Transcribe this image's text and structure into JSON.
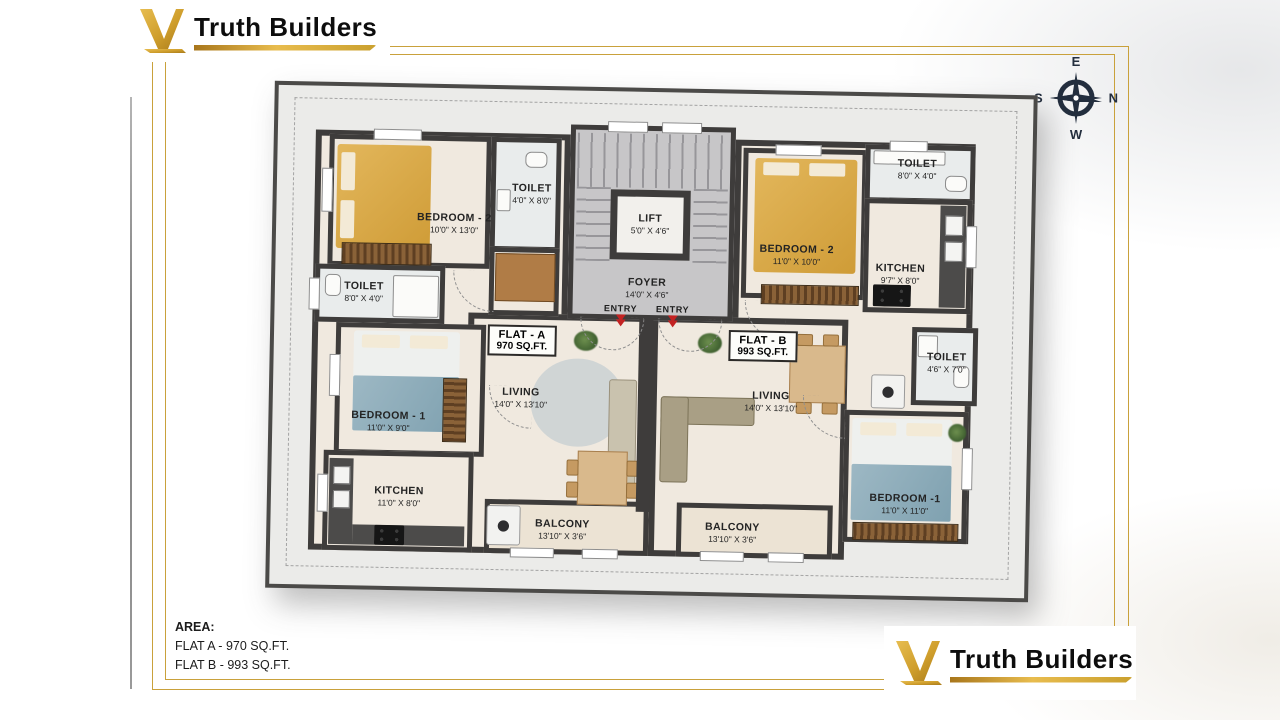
{
  "brand": {
    "name": "Truth Builders",
    "gold": "#D2A032",
    "text_color": "#0d0d0d"
  },
  "compass": {
    "top": "E",
    "right": "N",
    "left": "S",
    "bottom": "W"
  },
  "plan": {
    "flat_a": {
      "label": "FLAT - A",
      "area": "970 SQ.FT.",
      "bedroom2": {
        "name": "BEDROOM - 2",
        "dims": "10'0\" X 13'0\""
      },
      "toilet_attached": {
        "name": "TOILET",
        "dims": "4'0\" X 8'0\""
      },
      "toilet_common": {
        "name": "TOILET",
        "dims": "8'0\" X 4'0\""
      },
      "bedroom1": {
        "name": "BEDROOM - 1",
        "dims": "11'0\" X 9'0\""
      },
      "kitchen": {
        "name": "KITCHEN",
        "dims": "11'0\" X 8'0\""
      },
      "living": {
        "name": "LIVING",
        "dims": "14'0\" X 13'10\""
      },
      "balcony": {
        "name": "BALCONY",
        "dims": "13'10\" X 3'6\""
      }
    },
    "flat_b": {
      "label": "FLAT - B",
      "area": "993 SQ.FT.",
      "bedroom2": {
        "name": "BEDROOM - 2",
        "dims": "11'0\" X 10'0\""
      },
      "toilet_top": {
        "name": "TOILET",
        "dims": "8'0\" X 4'0\""
      },
      "kitchen": {
        "name": "KITCHEN",
        "dims": "9'7\" X 8'0\""
      },
      "toilet_side": {
        "name": "TOILET",
        "dims": "4'6\" X 7'0\""
      },
      "living": {
        "name": "LIVING",
        "dims": "14'0\" X 13'10\""
      },
      "bedroom1": {
        "name": "BEDROOM -1",
        "dims": "11'0\" X 11'0\""
      },
      "balcony": {
        "name": "BALCONY",
        "dims": "13'10\" X 3'6\""
      }
    },
    "common": {
      "lift": {
        "name": "LIFT",
        "dims": "5'0\" X 4'6\""
      },
      "foyer": {
        "name": "FOYER",
        "dims": "14'0\" X 4'6\""
      },
      "entry_left": "ENTRY",
      "entry_right": "ENTRY"
    }
  },
  "footer": {
    "area_title": "AREA:",
    "flat_a_line": "FLAT A - 970 SQ.FT.",
    "flat_b_line": "FLAT B - 993 SQ.FT."
  }
}
